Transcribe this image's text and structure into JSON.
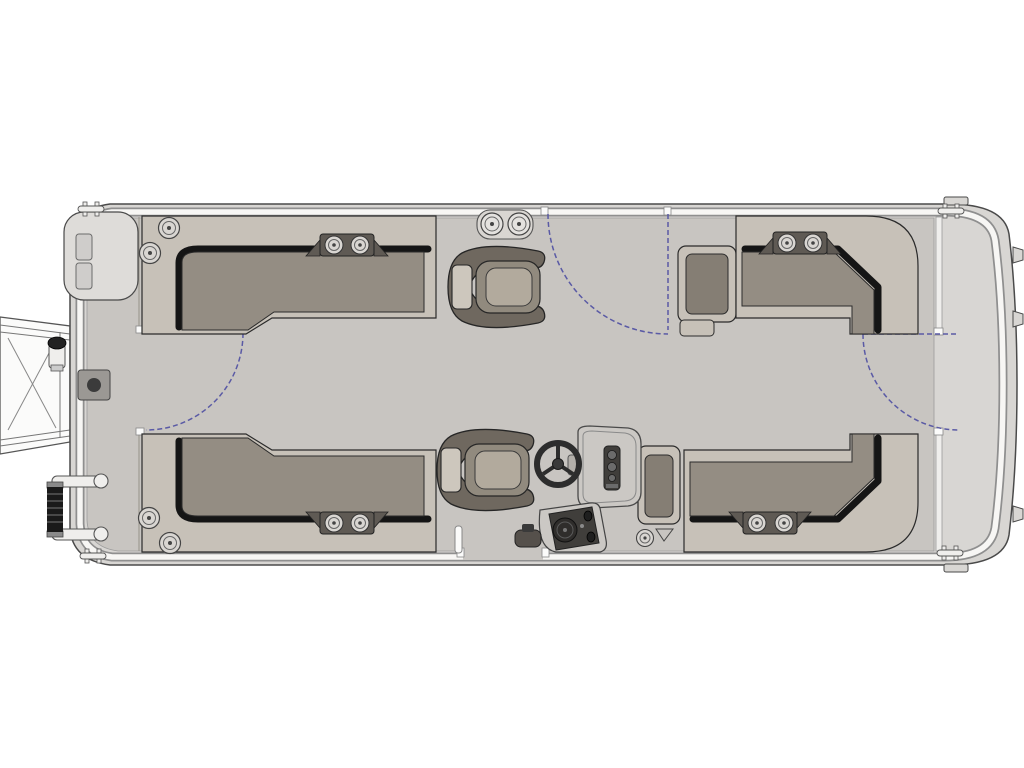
{
  "diagram": {
    "title": "Pontoon boat floor plan - overhead view",
    "style": "technical line drawing, no text labels"
  },
  "colors": {
    "background": "#ffffff",
    "hull": "#d8d6d3",
    "hull_outline": "#4a4a4a",
    "fence": "#f7f6f4",
    "fence_edge": "#8f8f8f",
    "deck": "#c8c5c1",
    "deck_line": "#9c9c9c",
    "seat_frame": "#c7c1b8",
    "seat_cushion": "#948d83",
    "seat_shadow": "#151515",
    "armrest_inner": "#857e74",
    "chair_shell": "#6f685f",
    "chair_back": "#918a7e",
    "chair_pad": "#b2aa9d",
    "chair_front": "#cdc7bd",
    "console": "#cbc8c4",
    "console_dark": "#403e3b",
    "speaker": "#2f2d2b",
    "tray": "#5f5a54",
    "cup_fill": "#d9d6d2",
    "gate": "#5a5aa5",
    "hardware": "#efeeec",
    "ladder_black": "#1a1a1a",
    "nose": "#dedcd9",
    "nose_tab": "#cfcdcb",
    "plate": "#9b9894",
    "plate_dot": "#3b3b3b",
    "white": "#fbfbfa",
    "outline_soft": "#555555"
  },
  "components": {
    "boat": {
      "label": "Pontoon boat floor plan"
    },
    "hull": {
      "label": "Pontoon deck platform with fence rail"
    },
    "bow_gangway": {
      "label": "Bow boarding ramp frame"
    },
    "bow_ladder": {
      "label": "Stowed telescoping boarding ladder"
    },
    "bow_light": {
      "label": "Bow docking light pole"
    },
    "bow_plate": {
      "label": "Bow deck access plate"
    },
    "bow_nose": {
      "label": "Bow nose cone panel"
    },
    "cleat": {
      "label": "Mooring cleat",
      "count": 4
    },
    "gate_bow": {
      "label": "Bow port entry gate swing"
    },
    "gate_side": {
      "label": "Starboard side entry gate swing"
    },
    "gate_stern": {
      "label": "Stern entry gate swing"
    },
    "gate_post": {
      "label": "Gate post"
    },
    "lounge_bow_port": {
      "label": "Bow port L-lounge seat"
    },
    "lounge_bow_starboard": {
      "label": "Bow starboard L-lounge seat"
    },
    "lounge_stern_port": {
      "label": "Stern port L-lounge seat"
    },
    "lounge_stern_starboard": {
      "label": "Stern starboard L-lounge seat"
    },
    "captain_chair_fwd": {
      "label": "Forward swivel captain chair"
    },
    "captain_chair_helm": {
      "label": "Helm swivel captain chair"
    },
    "helm_console": {
      "label": "Helm console with windscreen and gauges"
    },
    "steering_wheel": {
      "label": "Steering wheel"
    },
    "stereo_pod": {
      "label": "Helm side speaker / control pod"
    },
    "cupholder": {
      "label": "Cup holder"
    },
    "cup_tray": {
      "label": "Dual cup holder tray"
    },
    "table_post": {
      "label": "Deck gate post"
    },
    "stern_platform": {
      "label": "Stern extended platform"
    },
    "stern_tab": {
      "label": "Stern mounting tab",
      "count": 3
    }
  }
}
